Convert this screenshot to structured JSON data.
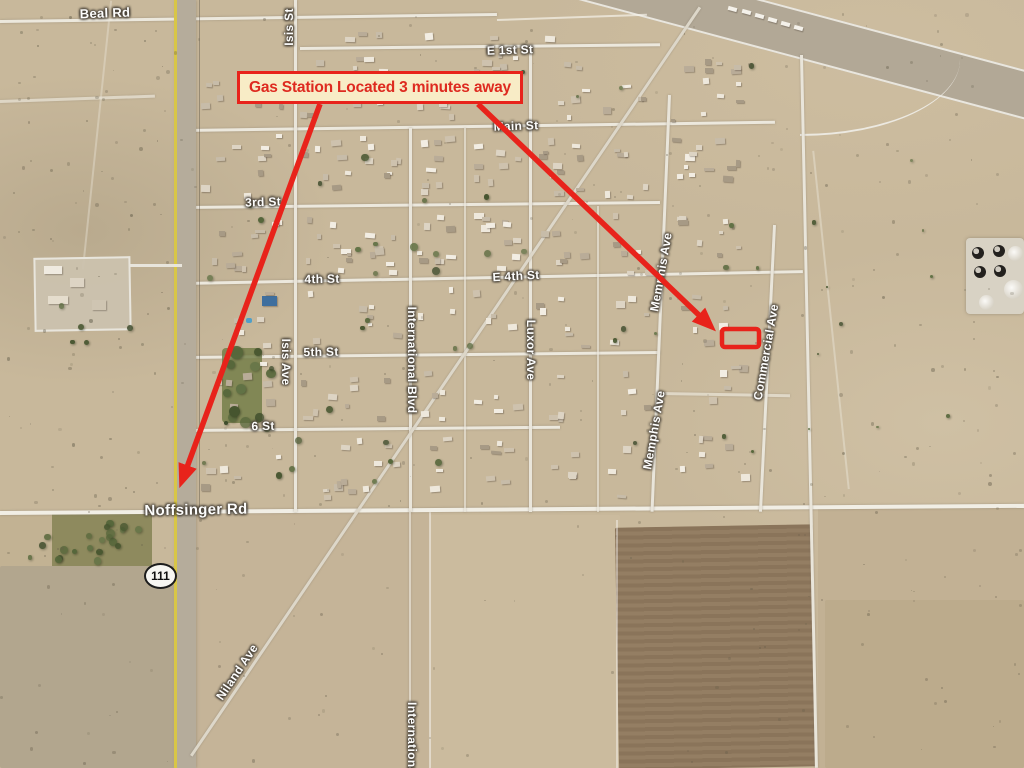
{
  "annotation": {
    "label": "Gas Station Located 3 minutes away",
    "accent_color": "#e8231b",
    "box_fill": "#f8ecc6",
    "text_color": "#de2a20"
  },
  "map": {
    "view": "satellite",
    "highway_shield": {
      "number": "111"
    },
    "labels": {
      "beal_rd": "Beal Rd",
      "isis_st": "Isis St",
      "e_1st_st": "E 1st St",
      "main_st": "Main St",
      "third_st": "3rd St",
      "fourth_st": "4th St",
      "e_4th_st": "E 4th St",
      "fifth_st": "5th St",
      "sixth_st": "6 St",
      "noffsinger_rd": "Noffsinger Rd",
      "isis_ave": "Isis Ave",
      "international_blvd": "International Blvd",
      "luxor_ave": "Luxor Ave",
      "memphis_ave_north": "Memphis Ave",
      "memphis_ave_south": "Memphis Ave",
      "commercial_ave": "Commercial Ave",
      "niland_ave": "Niland Ave",
      "international_south": "International"
    }
  }
}
